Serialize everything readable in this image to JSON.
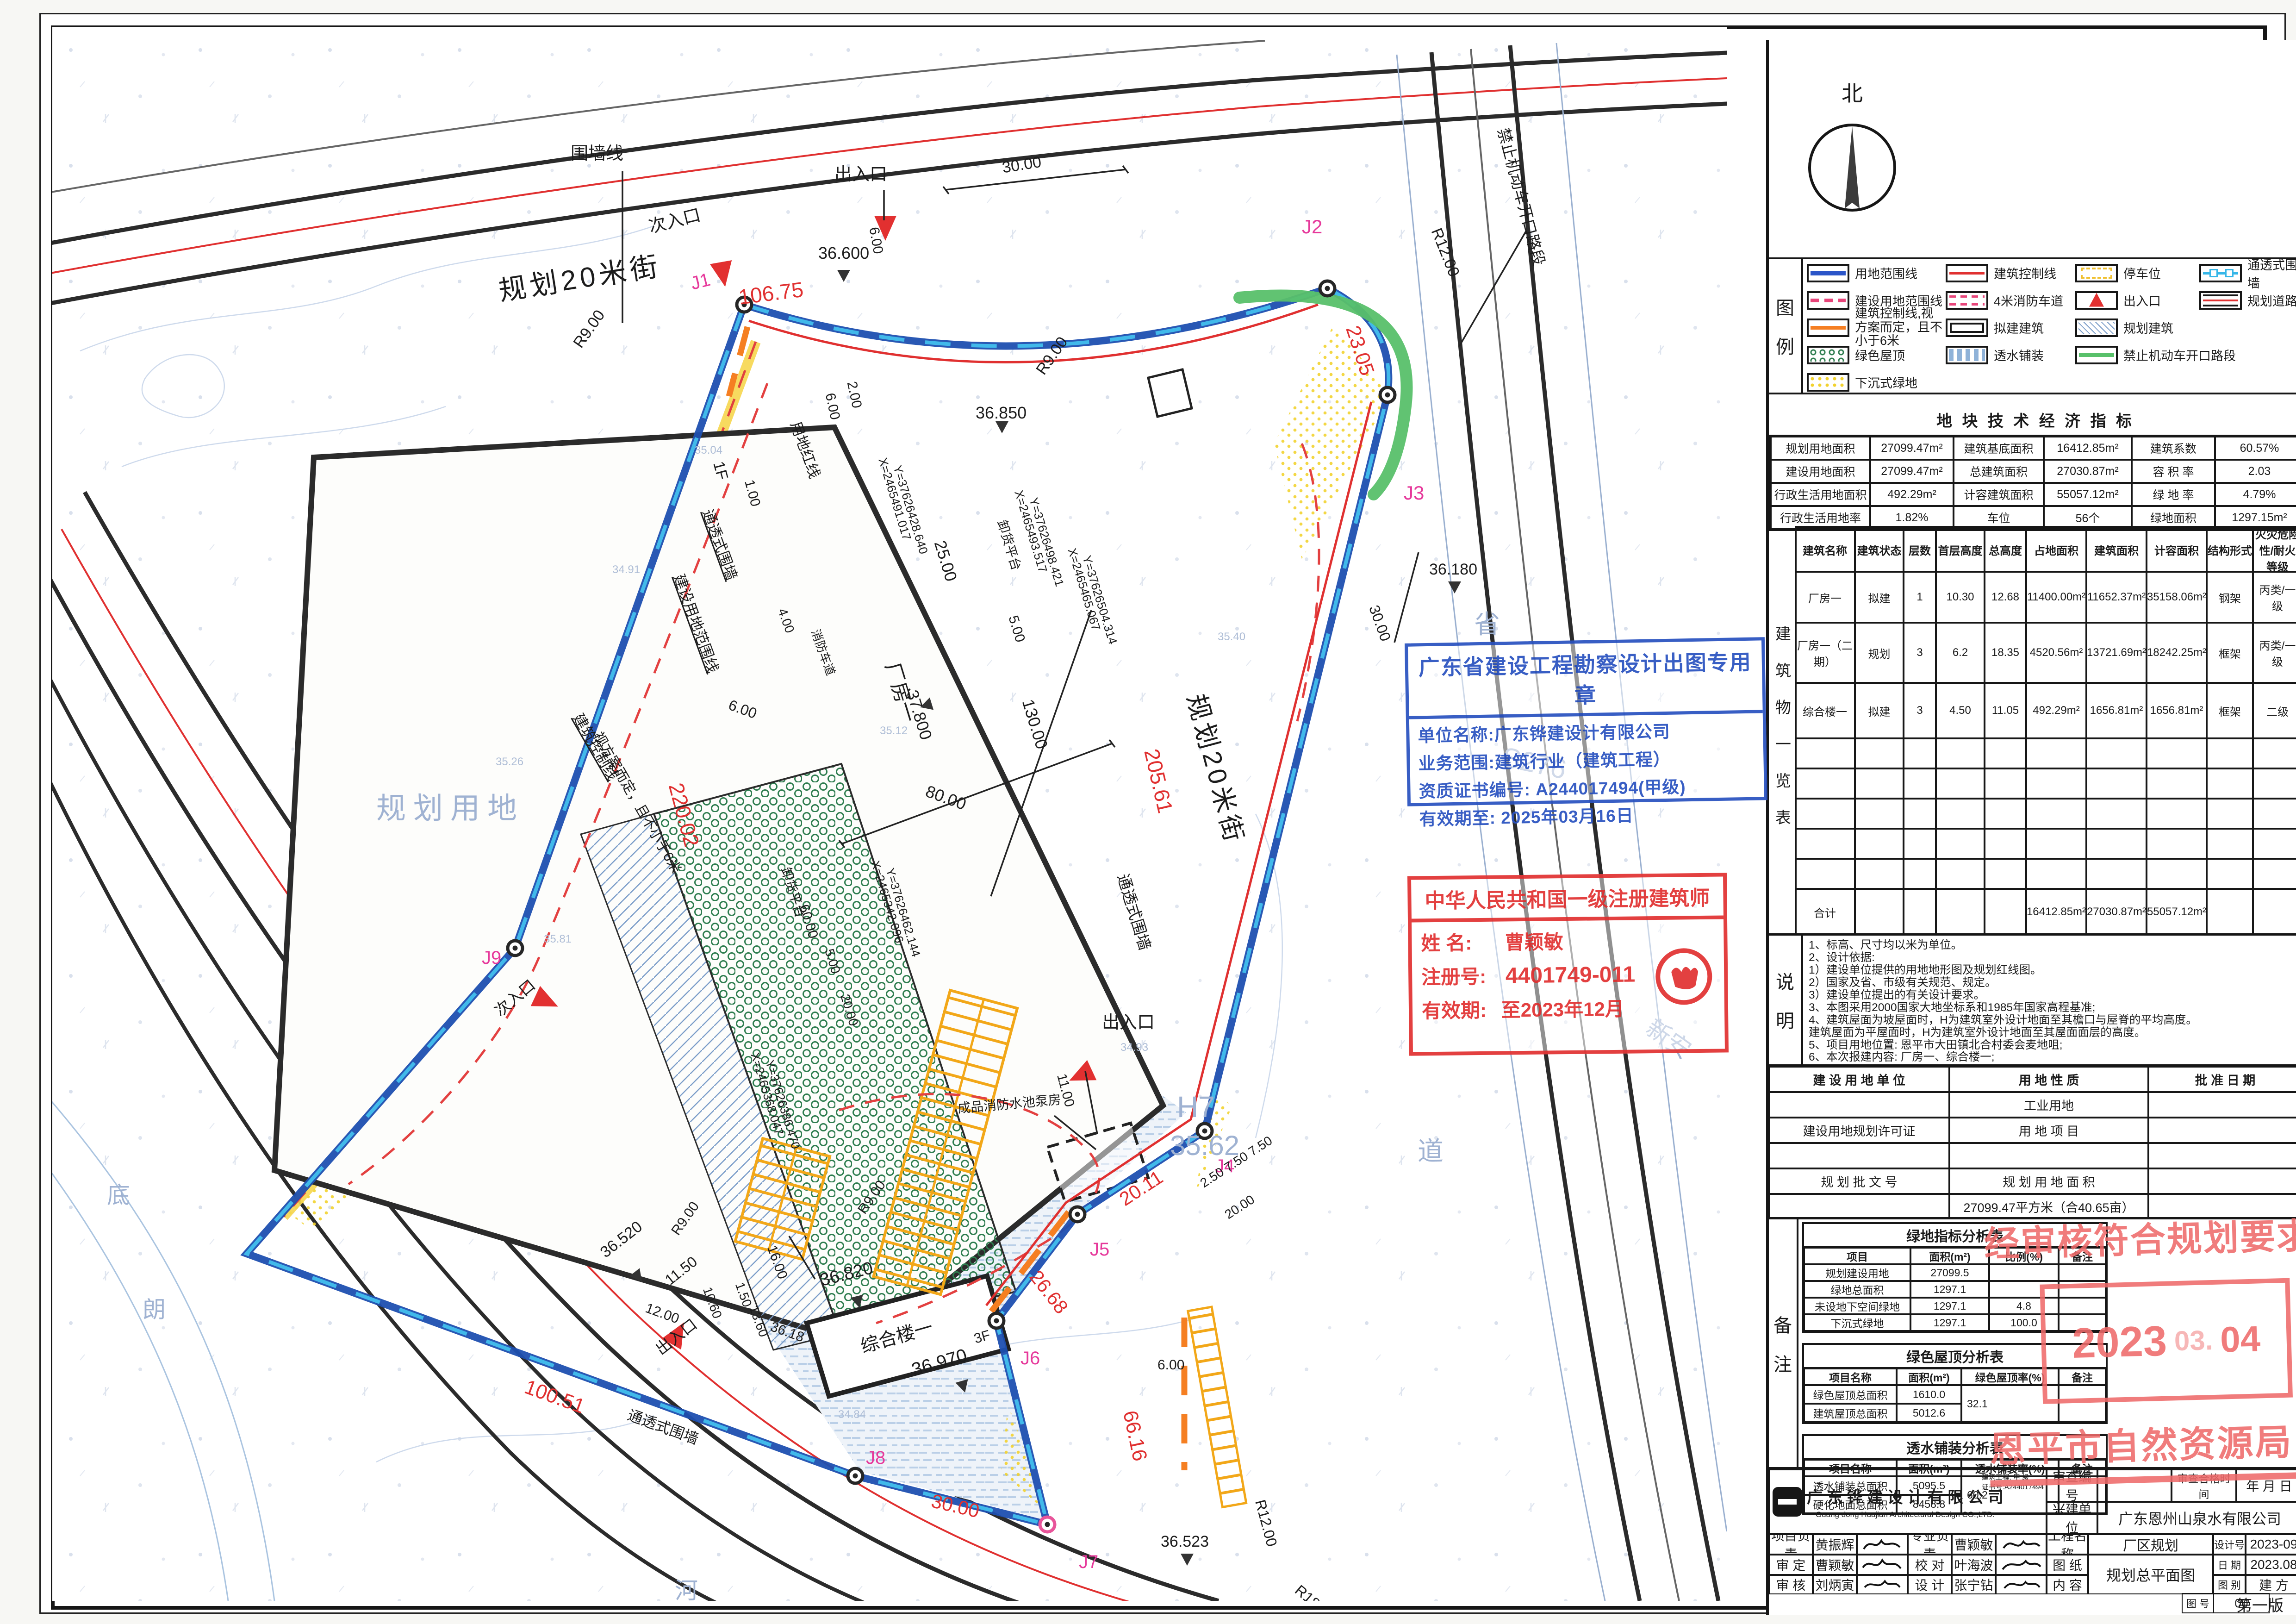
{
  "compass_label": "北",
  "plan": {
    "labels": [
      "围墙线",
      "次入口",
      "规划20米街",
      "106.75",
      "36.600",
      "出入口",
      "6.00",
      "30.00",
      "J2",
      "R12.00",
      "23.05",
      "禁止机动车开口路段",
      "J3",
      "36.180",
      "30.00",
      "J1",
      "R9.00",
      "R9.00",
      "36.850",
      "2.00",
      "6.00",
      "1F",
      "1.00",
      "25.00",
      "卸货平台",
      "5.00",
      "X=2465491.017",
      "Y=37626428.640",
      "X=2465493.517",
      "Y=37626498.421",
      "X=2465465.067",
      "Y=37626504.314",
      "X=2465368.047",
      "Y=37626386.470",
      "X=2465342.096",
      "Y=37626462.144",
      "厂房一",
      "37.800",
      "130.00",
      "80.00",
      "220.02",
      "通透式围墙",
      "建设用地范围线",
      "用地红线",
      "4.00",
      "消防车道",
      "6.00",
      "规划用地",
      "建筑控制线",
      "视方案而定，且不小于6米",
      "J9",
      "次入口",
      "100.51",
      "出入口",
      "36.520",
      "11.50",
      "通透式围墙",
      "J8",
      "30.00",
      "J7",
      "36.523",
      "R12.00",
      "R18.00",
      "66.16",
      "6.00",
      "J6",
      "26.68",
      "J5",
      "20.11",
      "J4",
      "成品消防水池泵房",
      "综合楼一",
      "36.970",
      "3F",
      "36.820",
      "16.00",
      "12.00",
      "10.60",
      "13.60",
      "1.50",
      "36.18",
      "R9.00",
      "R9.00",
      "出入口",
      "11.00",
      "H7",
      "35.62",
      "通透式围墙",
      "规划20米街",
      "205.61",
      "2.50 7.50 7.50",
      "20.00",
      "S276",
      "省",
      "道",
      "新安",
      "底",
      "河",
      "朗",
      "卸货平台",
      "60.00",
      "5.00",
      "20.00",
      "34.91",
      "35.26",
      "35.12",
      "35.81",
      "35.04",
      "34.93",
      "35.40",
      "34.84"
    ]
  },
  "legend": {
    "title_top": "图",
    "title_bottom": "例",
    "items": [
      {
        "label": "用地范围线"
      },
      {
        "label": "建筑控制线"
      },
      {
        "label": "停车位"
      },
      {
        "label": "通透式围墙"
      },
      {
        "label": "建设用地范围线"
      },
      {
        "label": "4米消防车道"
      },
      {
        "label": "出入口"
      },
      {
        "label": "规划道路"
      },
      {
        "label": "建筑控制线,视方案而定，且不小于6米"
      },
      {
        "label": "拟建建筑"
      },
      {
        "label": "规划建筑"
      },
      {
        "label": "绿色屋顶"
      },
      {
        "label": "透水铺装"
      },
      {
        "label": "禁止机动车开口路段"
      },
      {
        "label": "下沉式绿地"
      }
    ]
  },
  "tech": {
    "title": "地 块 技 术 经 济 指 标",
    "rows": [
      [
        "规划用地面积",
        "27099.47m²",
        "建筑基底面积",
        "16412.85m²",
        "建筑系数",
        "60.57%"
      ],
      [
        "建设用地面积",
        "27099.47m²",
        "总建筑面积",
        "27030.87m²",
        "容 积 率",
        "2.03"
      ],
      [
        "行政生活用地面积",
        "492.29m²",
        "计容建筑面积",
        "55057.12m²",
        "绿 地 率",
        "4.79%"
      ],
      [
        "行政生活用地率",
        "1.82%",
        "车位",
        "56个",
        "绿地面积",
        "1297.15m²"
      ]
    ]
  },
  "buildings": {
    "side": "建 筑 物 一 览 表",
    "headers": [
      "建筑名称",
      "建筑状态",
      "层数",
      "首层高度",
      "总高度",
      "占地面积",
      "建筑面积",
      "计容面积",
      "结构形式",
      "火灾危险性/耐火等级"
    ],
    "rows": [
      [
        "厂房一",
        "拟建",
        "1",
        "10.30",
        "12.68",
        "11400.00m²",
        "11652.37m²",
        "35158.06m²",
        "钢架",
        "丙类/一级"
      ],
      [
        "厂房一（二期）",
        "规划",
        "3",
        "6.2",
        "18.35",
        "4520.56m²",
        "13721.69m²",
        "18242.25m²",
        "框架",
        "丙类/一级"
      ],
      [
        "综合楼一",
        "拟建",
        "3",
        "4.50",
        "11.05",
        "492.29m²",
        "1656.81m²",
        "1656.81m²",
        "框架",
        "二级"
      ]
    ],
    "total": [
      "合计",
      "16412.85m²",
      "27030.87m²",
      "55057.12m²"
    ]
  },
  "notes": {
    "side_top": "说",
    "side_bottom": "明",
    "lines": [
      "1、标高、尺寸均以米为单位。",
      "2、设计依据:",
      "    1）建设单位提供的用地地形图及规划红线图。",
      "    2）国家及省、市级有关规范、规定。",
      "    3）建设单位提出的有关设计要求。",
      "3、本图采用2000国家大地坐标系和1985年国家高程基准;",
      "4、建筑屋面为坡屋面时，H为建筑室外设计地面至其檐口与屋脊的平均高度。",
      "    建筑屋面为平屋面时，H为建筑室外设计地面至其屋面面层的高度。",
      "5、项目用地位置: 恩平市大田镇北合村委会麦地咀;",
      "6、本次报建内容: 厂房一、综合楼一;"
    ]
  },
  "landuse": {
    "rows": [
      [
        "建 设 用 地 单 位",
        "用 地 性 质",
        "批 准 日 期"
      ],
      [
        "",
        "工业用地",
        ""
      ],
      [
        "建设用地规划许可证",
        "用 地 项 目",
        ""
      ],
      [
        "",
        "",
        ""
      ],
      [
        "规 划 批 文 号",
        "规 划 用 地 面 积",
        ""
      ],
      [
        "",
        "27099.47平方米（合40.65亩）",
        ""
      ]
    ]
  },
  "remark": {
    "side_top": "备",
    "side_bottom": "注",
    "green": {
      "title": "绿地指标分析表",
      "headers": [
        "项目",
        "面积(m²)",
        "比例(%)",
        "备注"
      ],
      "rows": [
        [
          "规划建设用地",
          "27099.5",
          "",
          ""
        ],
        [
          "绿地总面积",
          "1297.1",
          "",
          ""
        ],
        [
          "未设地下空间绿地",
          "1297.1",
          "4.8",
          ""
        ],
        [
          "下沉式绿地",
          "1297.1",
          "100.0",
          ""
        ]
      ]
    },
    "roof": {
      "title": "绿色屋顶分析表",
      "headers": [
        "项目名称",
        "面积(m²)",
        "绿色屋顶率(%)",
        "备注"
      ],
      "r1_label": "绿色屋顶总面积",
      "r1_val": "1610.0",
      "r2_label": "建筑屋顶总面积",
      "r2_val": "5012.6",
      "rate": "32.1"
    },
    "perm": {
      "title": "透水铺装分析表",
      "headers": [
        "项目名称",
        "面积(m²)",
        "透水铺装率(%)",
        "备注"
      ],
      "r1_label": "透水铺装总面积",
      "r1_val": "5095.5",
      "r2_label": "硬化地面总面积",
      "r2_val": "8458.8",
      "rate": "60.2"
    }
  },
  "titleblock": {
    "company_cn": "广 东 铧 建 设 计 有 限 公 司",
    "company_en": "Guang dong Huajian Architectural Design CO.,LTD.",
    "cert1": "建筑工程: 甲 级",
    "cert2": "证书号:A244017494",
    "review_no": "审查编号",
    "review_ok": "审查合格时间",
    "ymd": "年  月  日",
    "owner_label": "兴建单位",
    "owner": "广东恩州山泉水有限公司",
    "r1c1": "项目负责",
    "r1v1": "黄振辉",
    "r1c2": "专业负责",
    "r1v2": "曹颖敏",
    "r2c1": "审  定",
    "r2v1": "曹颖敏",
    "r2c2": "校  对",
    "r2v2": "叶海波",
    "r3c1": "审  核",
    "r3v1": "刘炳寅",
    "r3c2": "设  计",
    "r3v2": "张宁钻",
    "pj_label": "工程名称",
    "pj": "厂区规划",
    "sheet_label": "图  纸",
    "content_label": "内  容",
    "drawing": "规划总平面图",
    "dno_label": "设计号",
    "dno": "2023-09",
    "date_label": "日 期",
    "date": "2023.08",
    "cat_label": "图 别",
    "cat": "建 方",
    "no_label": "图 号",
    "no": "00",
    "edition": "第一版"
  },
  "stamps": {
    "blue": {
      "title": "广东省建设工程勘察设计出图专用章",
      "l1": "单位名称:广东铧建设计有限公司",
      "l2": "业务范围:建筑行业（建筑工程）",
      "l3": "资质证书编号: A244017494(甲级)",
      "l4": "有效期至: 2025年03月16日"
    },
    "architect": {
      "title": "中华人民共和国一级注册建筑师",
      "name_label": "姓  名:",
      "name": "曹颖敏",
      "reg_label": "注册号:",
      "reg": "4401749-011",
      "valid_label": "有效期:",
      "valid": "至2023年12月"
    },
    "approval": {
      "line": "经审核符合规划要求",
      "y": "2023",
      "m": "03.",
      "d": "04",
      "org": "恩平市自然资源局"
    }
  }
}
